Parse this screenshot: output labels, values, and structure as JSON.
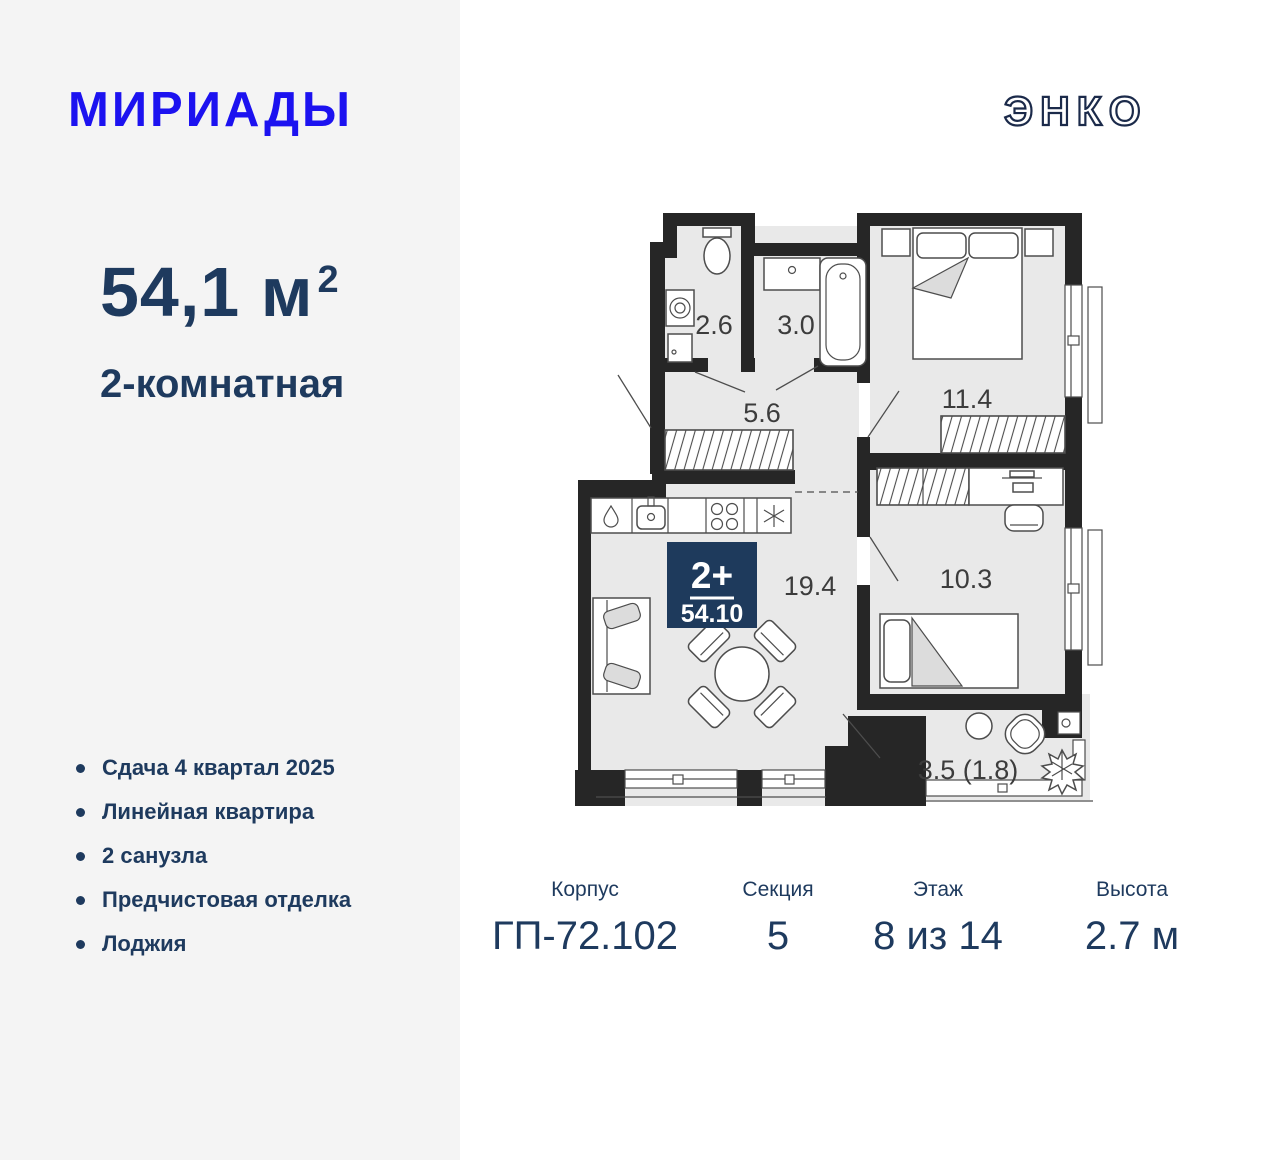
{
  "brand": {
    "name": "МИРИАДЫ",
    "developer": "ЭНКО"
  },
  "apartment": {
    "area": "54,1",
    "area_unit": "м",
    "area_sup": "2",
    "type": "2-комнатная"
  },
  "features": {
    "items": [
      "Сдача 4 квартал 2025",
      "Линейная квартира",
      "2 санузла",
      "Предчистовая отделка",
      "Лоджия"
    ]
  },
  "specs": {
    "items": [
      {
        "label": "Корпус",
        "value": "ГП-72.102"
      },
      {
        "label": "Секция",
        "value": "5"
      },
      {
        "label": "Этаж",
        "value": "8 из 14"
      },
      {
        "label": "Высота",
        "value": "2.7 м"
      }
    ]
  },
  "floorplan": {
    "badge": {
      "rooms": "2+",
      "area": "54.10"
    },
    "rooms": {
      "wc": "2.6",
      "bathroom": "3.0",
      "hallway": "5.6",
      "bedroom1": "11.4",
      "kitchen_living": "19.4",
      "bedroom2": "10.3",
      "loggia": "3.5 (1.8)"
    }
  },
  "colors": {
    "brand_blue": "#1c12f0",
    "navy_text": "#1e3a5e",
    "badge_navy": "#1e3a5c",
    "panel_gray": "#f4f4f4",
    "floor_gray": "#e9e9e9",
    "wall_black": "#262626"
  }
}
